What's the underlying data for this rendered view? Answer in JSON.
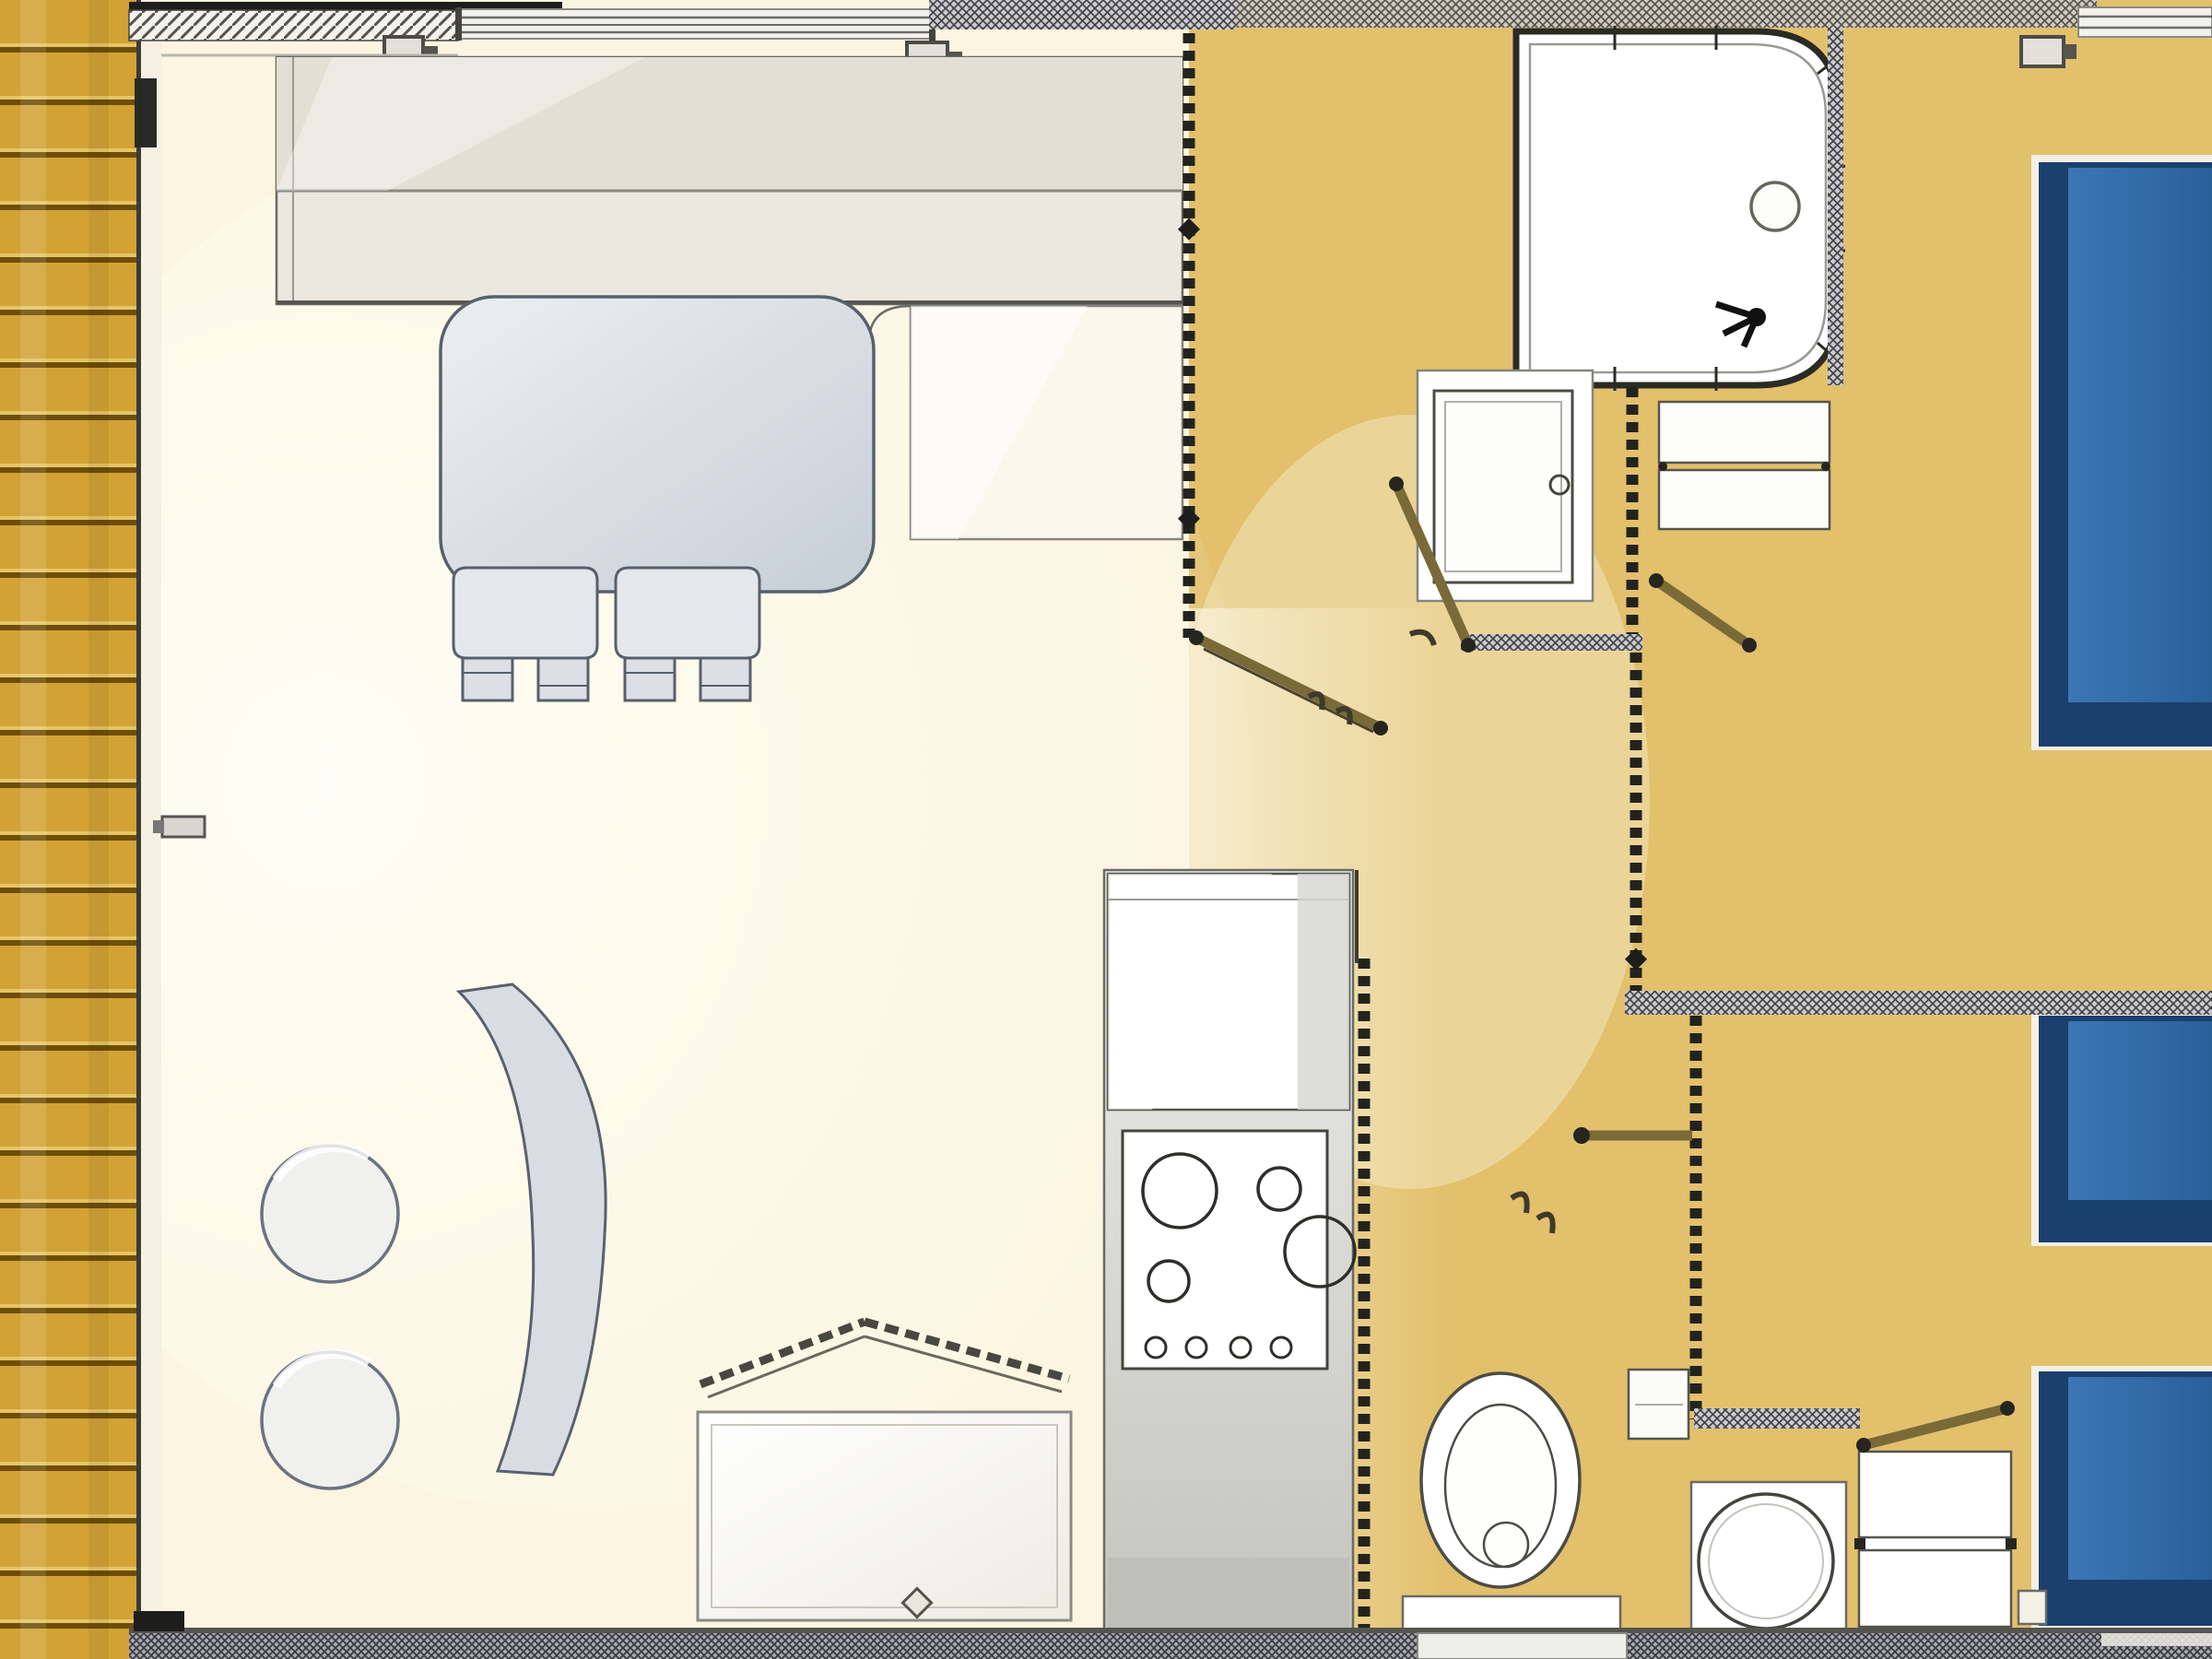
{
  "title": "mobile-home-floor-plan",
  "plan": {
    "rooms": [
      "terrace",
      "living-area",
      "dinette",
      "kitchen",
      "bathroom",
      "wc",
      "washroom",
      "hallway",
      "bedroom-double",
      "bedroom-twin"
    ],
    "fixtures": [
      "deck-planks",
      "lounge-bench",
      "corner-cabinet",
      "dining-table",
      "dining-chair",
      "curved-bench",
      "stool",
      "storage-chest",
      "fridge-cabinet",
      "hob-4-burners",
      "kitchen-counter",
      "shower-cubicle",
      "vanity-unit",
      "shelf-unit",
      "toilet",
      "wall-cabinet",
      "round-washbasin",
      "drawer-unit",
      "double-bed",
      "single-bed",
      "single-bed"
    ],
    "doors": [
      "entry-handle-left-wall",
      "door-living-hall",
      "door-bathroom",
      "door-bedroom-double",
      "door-wc",
      "door-bedroom-twin"
    ],
    "windows": [
      "window-living-top",
      "window-bedroom-top-right"
    ],
    "bed_count": {
      "double": 1,
      "single": 2
    },
    "burner_count": 4,
    "stool_count": 2
  },
  "colors": {
    "deck_wood": "#D2A235",
    "deck_groove": "#6E4E07",
    "exterior_wall": "#F5F0E2",
    "living_floor": "#FBF5E1",
    "hall_floor": "#E2C06C",
    "wall_line": "#3C3C36",
    "furniture_fill": "#E4E8EC",
    "furniture_line": "#57606C",
    "bench_fill": "#EBE8E0",
    "cream_cabinet": "#FAF7ED",
    "fixture_white": "#FFFFFF",
    "fixture_line": "#4C4C46",
    "counter_fill": "#DDDDD9",
    "bed_blue": "#2F6BA6",
    "bed_navy": "#1B3F6E",
    "bed_frame": "#F3F0E6",
    "door_leaf": "#7A6A38",
    "door_dot": "#26251F",
    "stool_fill": "#F0F0EE",
    "window_line": "#6B6B66",
    "glass_fill": "#F2F1EC"
  }
}
